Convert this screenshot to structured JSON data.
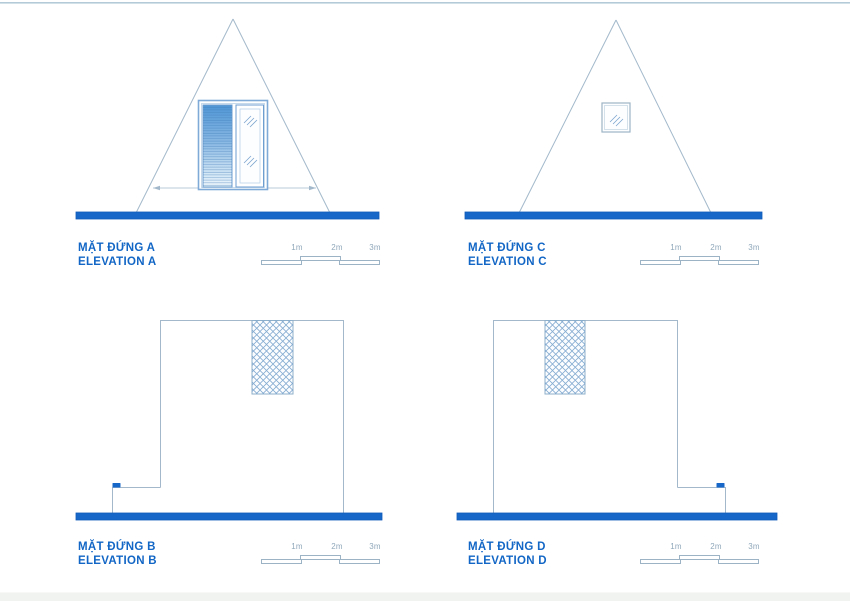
{
  "drawing": {
    "panels": [
      {
        "id": "elevation-a",
        "title_line1": "MẶT ĐỨNG A",
        "title_line2": "ELEVATION A",
        "scale_labels": [
          "1m",
          "2m",
          "3m"
        ]
      },
      {
        "id": "elevation-c",
        "title_line1": "MẶT ĐỨNG C",
        "title_line2": "ELEVATION C",
        "scale_labels": [
          "1m",
          "2m",
          "3m"
        ]
      },
      {
        "id": "elevation-b",
        "title_line1": "MẶT ĐỨNG B",
        "title_line2": "ELEVATION B",
        "scale_labels": [
          "1m",
          "2m",
          "3m"
        ]
      },
      {
        "id": "elevation-d",
        "title_line1": "MẶT ĐỨNG D",
        "title_line2": "ELEVATION D",
        "scale_labels": [
          "1m",
          "2m",
          "3m"
        ]
      }
    ],
    "colors": {
      "ground_bar_blue": "#1767c9",
      "title_blue": "#1266c5",
      "line_work": "#a3b9cb",
      "scale_label_gray_blue": "#90a8ba",
      "door_louver_blue": "#4f97d6",
      "glass_hatch_blue": "#7fa6cf"
    }
  }
}
